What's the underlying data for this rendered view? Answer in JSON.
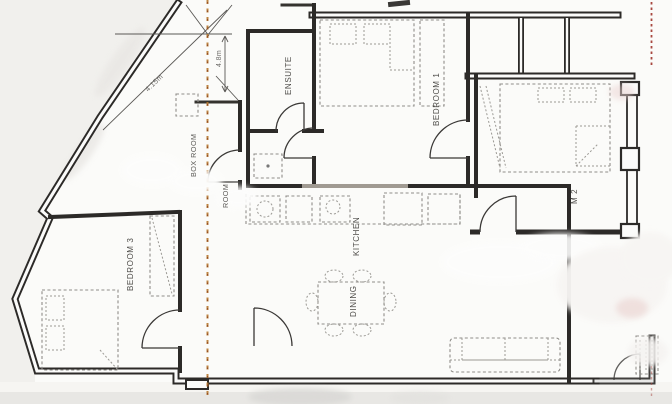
{
  "rooms": {
    "ensuite": "ENSUITE",
    "bedroom1": "BEDROOM 1",
    "bedroom2_partial": "M 2",
    "box_room": "BOX ROOM",
    "room_partial": "ROOM",
    "kitchen": "KITCHEN",
    "dining": "DINING",
    "bedroom3": "BEDROOM 3"
  },
  "dimensions": {
    "diagonal": "4.15m",
    "vertical": "4.8m"
  },
  "colors": {
    "wall": "#2c2a28",
    "section_line": "#b5772e",
    "section_line_accent": "#8a4020",
    "marker_line": "#a84840"
  }
}
